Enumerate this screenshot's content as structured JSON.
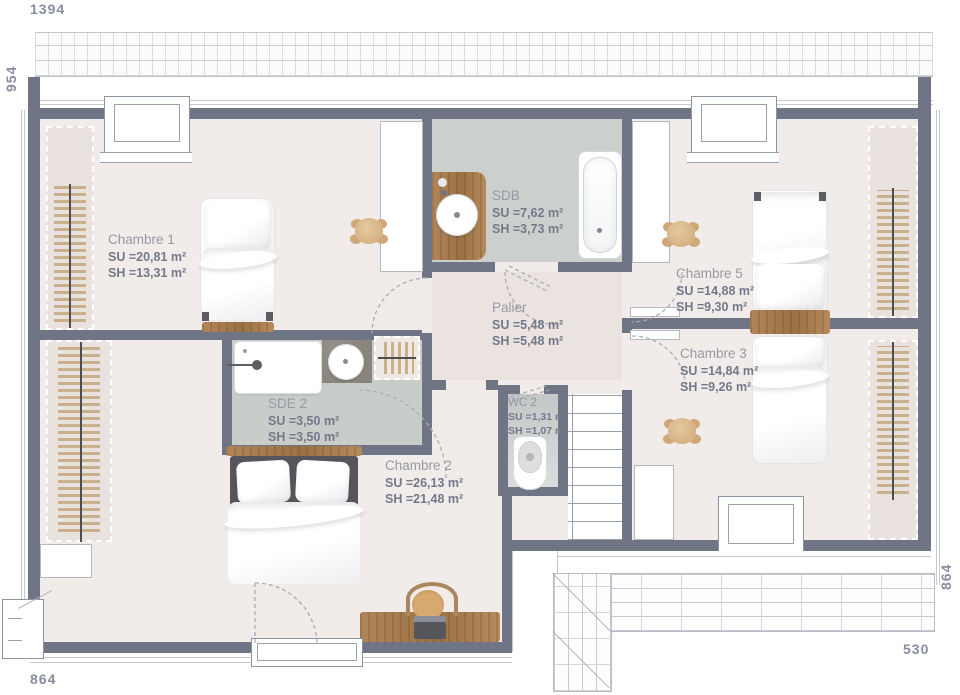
{
  "dimensions": {
    "top": "1394",
    "left": "954",
    "bottom_left": "864",
    "right": "864",
    "bottom_right": "530"
  },
  "rooms": {
    "chambre1": {
      "name": "Chambre 1",
      "su": "SU =20,81 m²",
      "sh": "SH =13,31 m²"
    },
    "sdb": {
      "name": "SDB",
      "su": "SU =7,62 m²",
      "sh": "SH =3,73 m²"
    },
    "chambre5": {
      "name": "Chambre 5",
      "su": "SU =14,88 m²",
      "sh": "SH =9,30 m²"
    },
    "palier": {
      "name": "Palier",
      "su": "SU =5,48 m²",
      "sh": "SH =5,48 m²"
    },
    "chambre3": {
      "name": "Chambre 3",
      "su": "SU =14,84 m²",
      "sh": "SH =9,26 m²"
    },
    "sde2": {
      "name": "SDE 2",
      "su": "SU =3,50 m²",
      "sh": "SH =3,50 m²"
    },
    "wc2": {
      "name": "WC 2",
      "su": "SU =1,31 m²",
      "sh": "SH =1,07 m²"
    },
    "chambre2": {
      "name": "Chambre 2",
      "su": "SU =26,13 m²",
      "sh": "SH =21,48 m²"
    }
  },
  "colors": {
    "wall": "#6f7585",
    "floor": "#f1ece9",
    "palier_floor": "#eae3e0",
    "wet_floor": "#ccd0cd",
    "sde_floor": "#c9cdca",
    "wood": "#b1855a",
    "hatch": "#c9ae8d"
  }
}
